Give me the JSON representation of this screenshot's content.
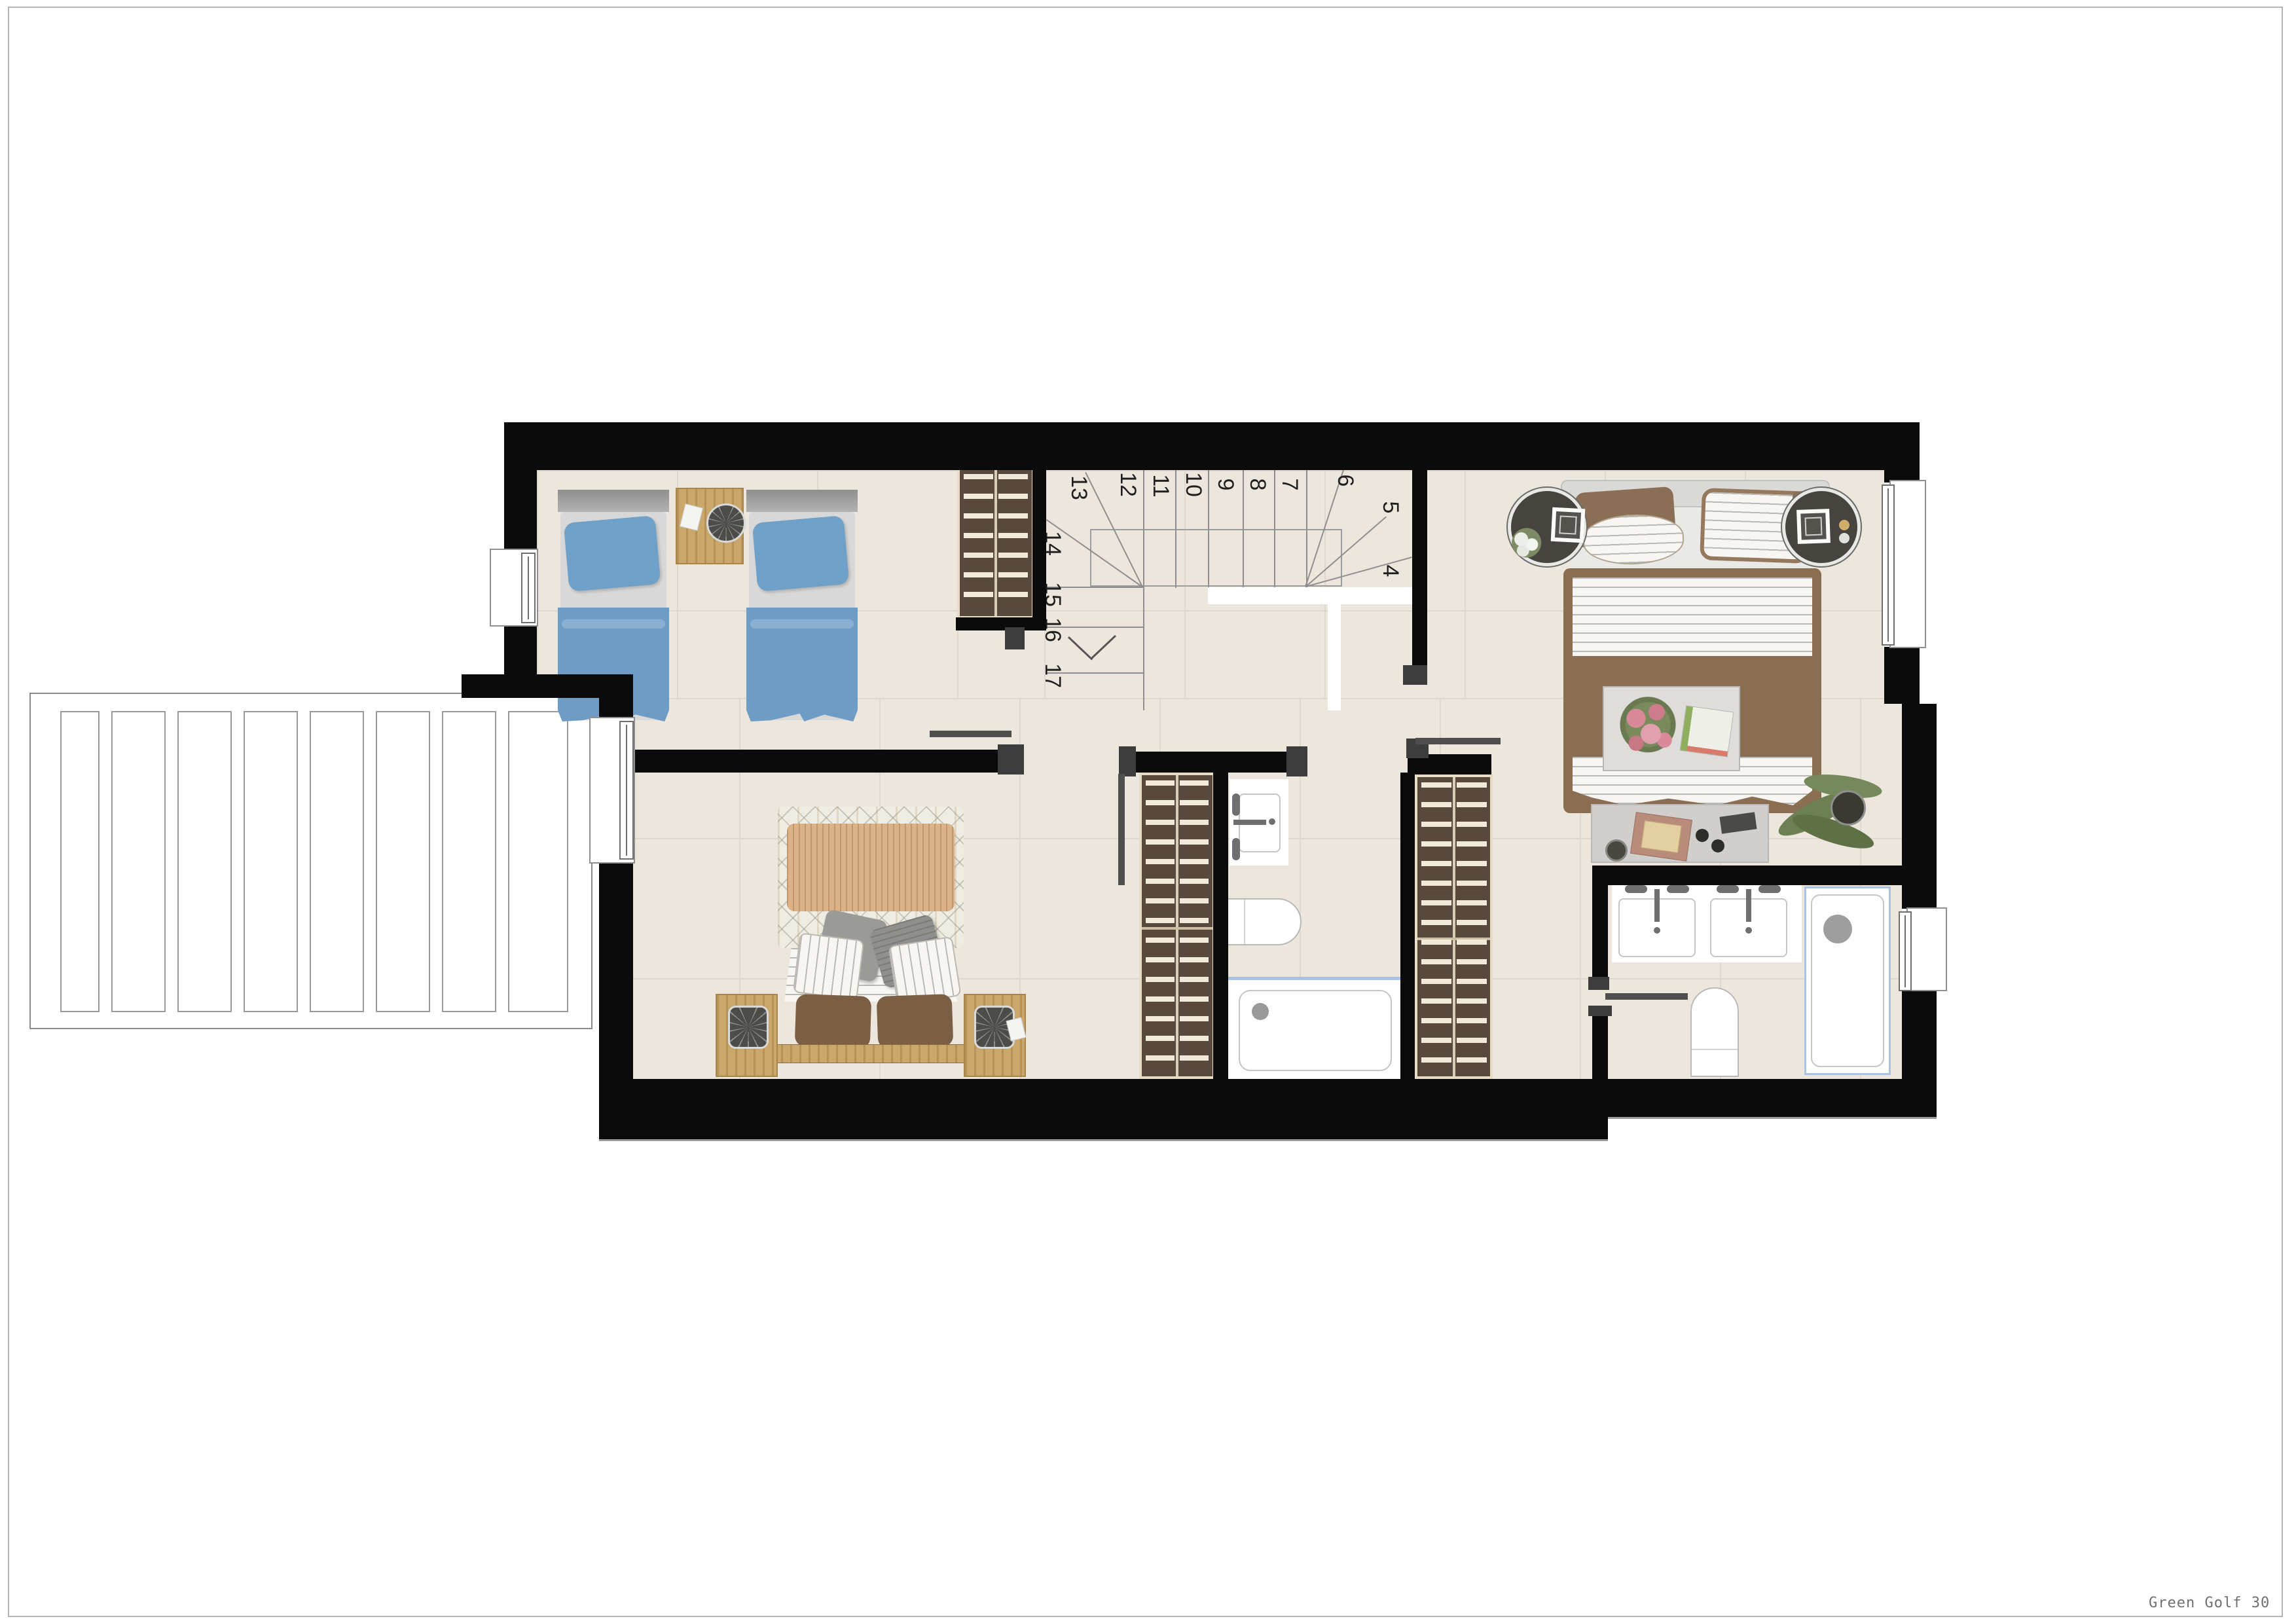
{
  "meta": {
    "project_label": "Green Golf 30"
  },
  "stairs": {
    "steps": [
      "4",
      "5",
      "6",
      "7",
      "8",
      "9",
      "10",
      "11",
      "12",
      "13",
      "14",
      "15",
      "16",
      "17"
    ]
  },
  "palette": {
    "wall": "#0b0b0b",
    "floor": "#ece6dd",
    "floor_line": "#e0d8cc",
    "bed_blue": "#6f9cc5",
    "pillow_blue": "#6fa0c8",
    "headboard_gray": "#9a9a9a",
    "wood": "#caa76b",
    "wardrobe_brown": "#59493c",
    "wardrobe_trim": "#e9dcc4",
    "bedding_brown": "#8a6e52",
    "throw_tan": "#ddb287",
    "fixture_white": "#ffffff",
    "fixture_blue_edge": "#a9c3e6",
    "plant_green": "#6d8054",
    "label_gray": "#707070"
  },
  "icons": [
    "ceiling-fan-icon",
    "drain-icon",
    "faucet-icon",
    "flowers-icon",
    "plant-icon",
    "picture-frame-icon",
    "stair-direction-arrow-icon",
    "window-icon",
    "sliding-door-icon"
  ]
}
